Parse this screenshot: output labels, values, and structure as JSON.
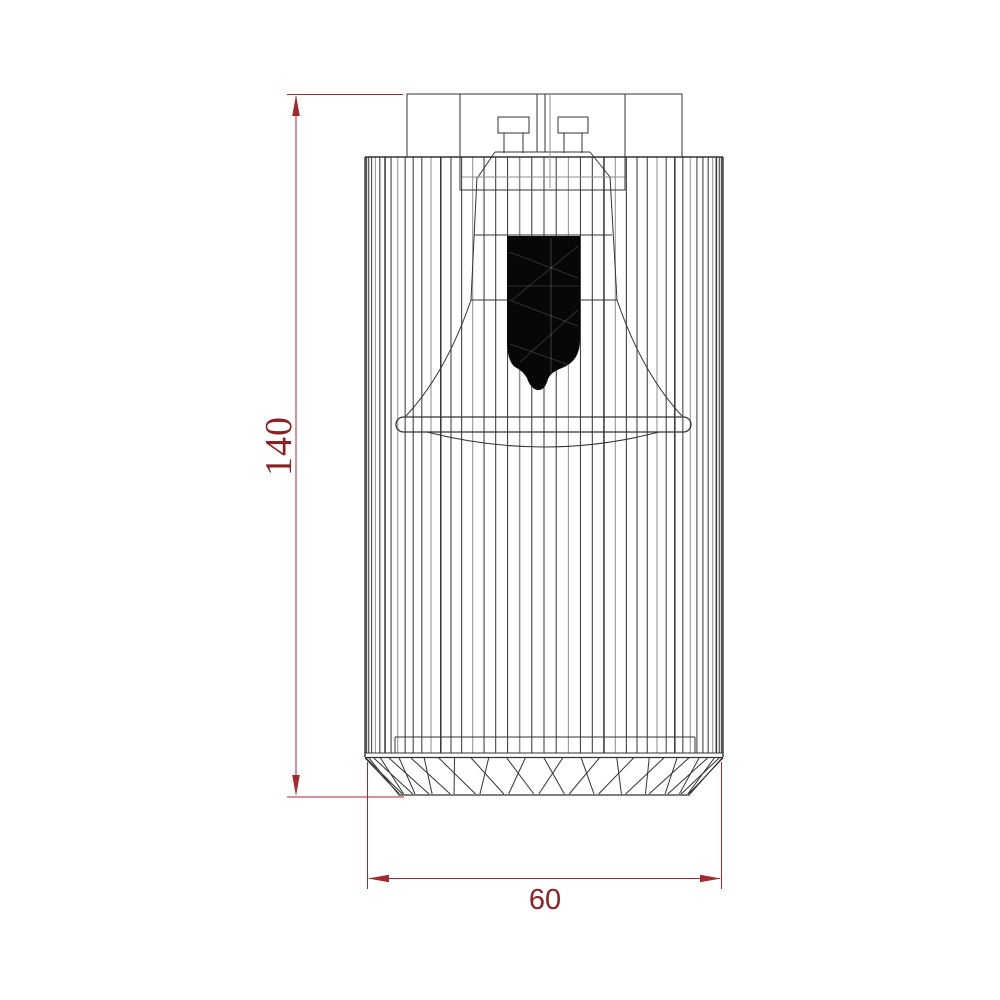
{
  "dimensions": {
    "height": {
      "label": "140"
    },
    "width": {
      "label": "60"
    }
  },
  "colors": {
    "background": "#ffffff",
    "dimension_line": "#a32a31",
    "dimension_text": "#8e2023",
    "line_dark": "#333333",
    "line_light": "#8f8f8f",
    "bulb_fill": "#070707",
    "bulb_texture": "#ffffff"
  }
}
